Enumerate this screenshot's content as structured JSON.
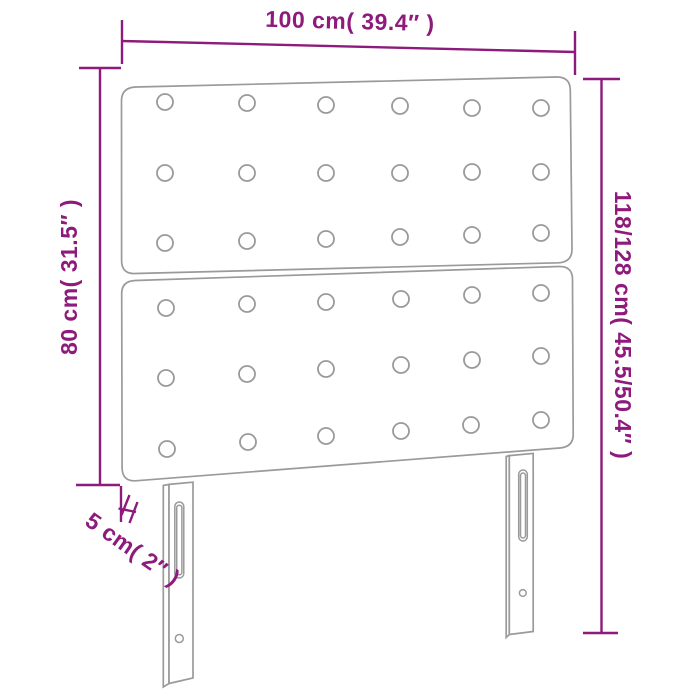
{
  "diagram": {
    "title": "headboard-dimension-diagram",
    "product": "tufted headboard with two legs",
    "colors": {
      "dimension_accent": "#8E1B7C",
      "drawing_outline": "#9A9A9A",
      "background": "#FFFFFF"
    },
    "dimensions": {
      "width": {
        "label": "100 cm( 39.4″ )"
      },
      "panel_height": {
        "label": "80 cm( 31.5″ )"
      },
      "total_height": {
        "label": "118/128 cm( 45.5/50.4″ )"
      },
      "thickness": {
        "label": "5 cm( 2″ )"
      }
    }
  }
}
